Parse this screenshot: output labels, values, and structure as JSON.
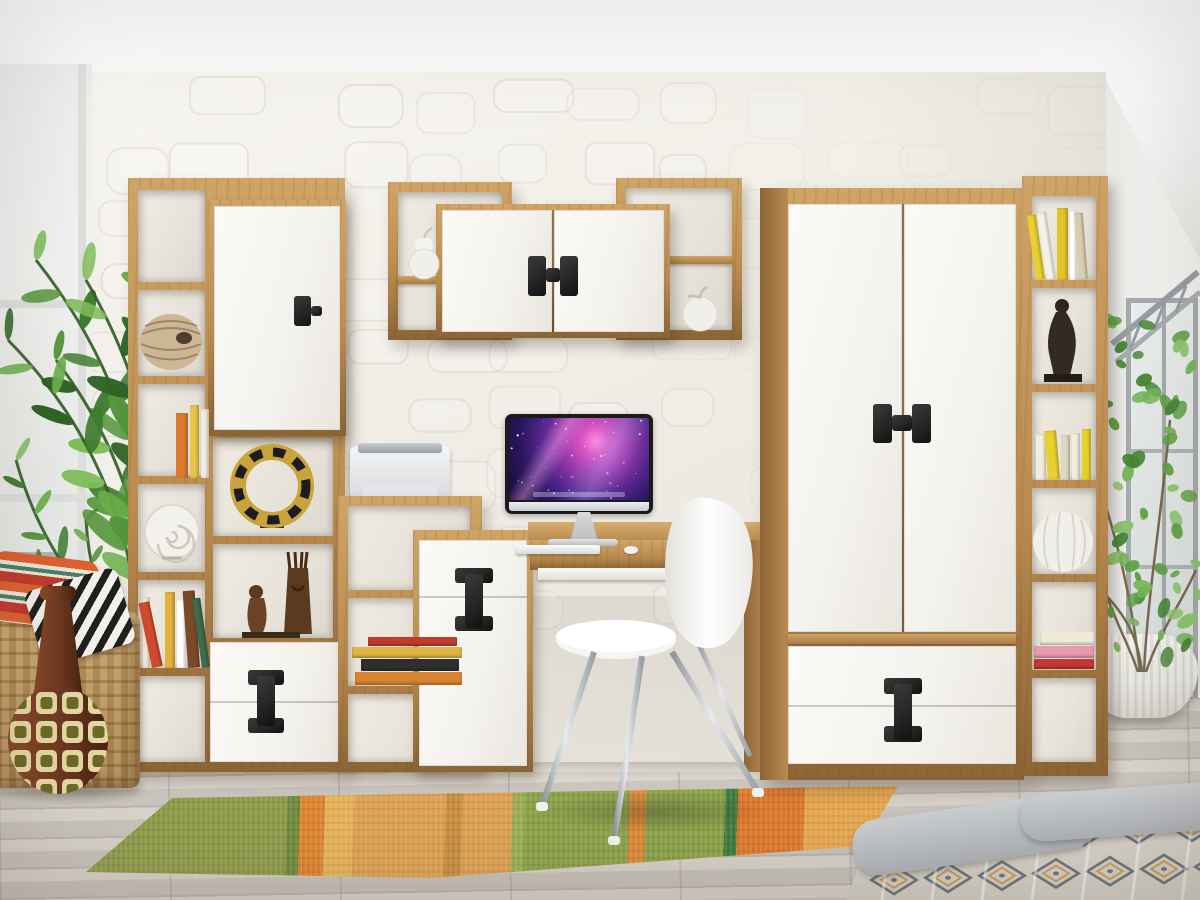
{
  "scene": {
    "type": "interior-photograph",
    "description": "Showroom photo of a kids-room furniture wall set in light artisan oak with glossy white fronts and black dumbbell-shaped handles: tall open shelving unit with door cabinet and drawers on the left, wall-mounted cabinet with side cubbies above a desk with an iMac and white chair in the center, a two-door wardrobe with drawers on the right, and a narrow open bookcase at its side. Decor: monstera plant, wicker basket with patterned pillows, patterned floor vase, rug runner on grey wood planks, ficus by the window, bed corner with grey blanket."
  },
  "colors": {
    "oak": "#bb8c50",
    "oak_light": "#cfa466",
    "oak_dark": "#8c6436",
    "front_white": "#f8f6f1",
    "handle_black": "#242424",
    "wall": "#efece5",
    "ceiling": "#fbfbfa",
    "floor": "#d3ccc3",
    "rug_green": "#8f9c4a",
    "rug_orange": "#e0862f",
    "rug_tan": "#dfa352",
    "plant_green": "#55973c",
    "plant_dark": "#2e5e24",
    "ficus_green": "#6fae4a",
    "chrome": "#b9bec3",
    "screen_purple": "#9738ac",
    "blanket_gray": "#b7babd",
    "basket": "#c59e60",
    "vase_brown": "#6f3a20",
    "vase_cream": "#e8d8a6",
    "vase_olive": "#6b6b26",
    "mask_gold": "#c9a43c",
    "wood_figure": "#5b3a20",
    "shell_white": "#f3f1ec"
  },
  "objects": {
    "left_shelf_unit": "tall oak shelving with white door cabinet and two drawers",
    "wall_shelf": "wall cabinet, two white doors, open oak cubbies with pear and apple ornaments",
    "desk": "oak desk with white pedestal cabinet and pull-out tray",
    "imac": "all-in-one computer with purple galaxy wallpaper, keyboard and mouse",
    "chair": "white molded chair with chrome legs",
    "wardrobe": "two-door white wardrobe with two drawers",
    "right_bookcase": "narrow oak bookcase with books, figurine and ribbed ball",
    "printer": "white inkjet printer",
    "monstera": "monstera plant at left window",
    "ficus": "ficus tree in white ribbed pot at right window",
    "basket": "wicker basket with two patterned pillows",
    "floor_vase": "brown bottle vase with cream square pattern",
    "rug": "green-orange ethnic runner rug",
    "bed": "bed corner with grey blanket over patterned quilt"
  },
  "book_palettes": {
    "left_lean": [
      "#d97a2e",
      "#e8c44a",
      "#f1ebdd",
      "#b8452f"
    ],
    "left_row": [
      "#f0e9d8",
      "#cf4a30",
      "#e2b13e",
      "#ffffff",
      "#7a4a28",
      "#3f6b4e",
      "#d97a2e"
    ],
    "stack_mid": [
      "#d9822f",
      "#2f2f2f",
      "#e0b342",
      "#c23b2e",
      "#e8e0cc"
    ],
    "right_top": [
      "#e8d02f",
      "#f5f1e3",
      "#e3c22c",
      "#ffffff",
      "#d8cfae"
    ],
    "right_lean": [
      "#f2eedf",
      "#e8d02f",
      "#dfd8c2"
    ],
    "right_stack": [
      "#c43832",
      "#e79ab0",
      "#f1ead8"
    ]
  }
}
